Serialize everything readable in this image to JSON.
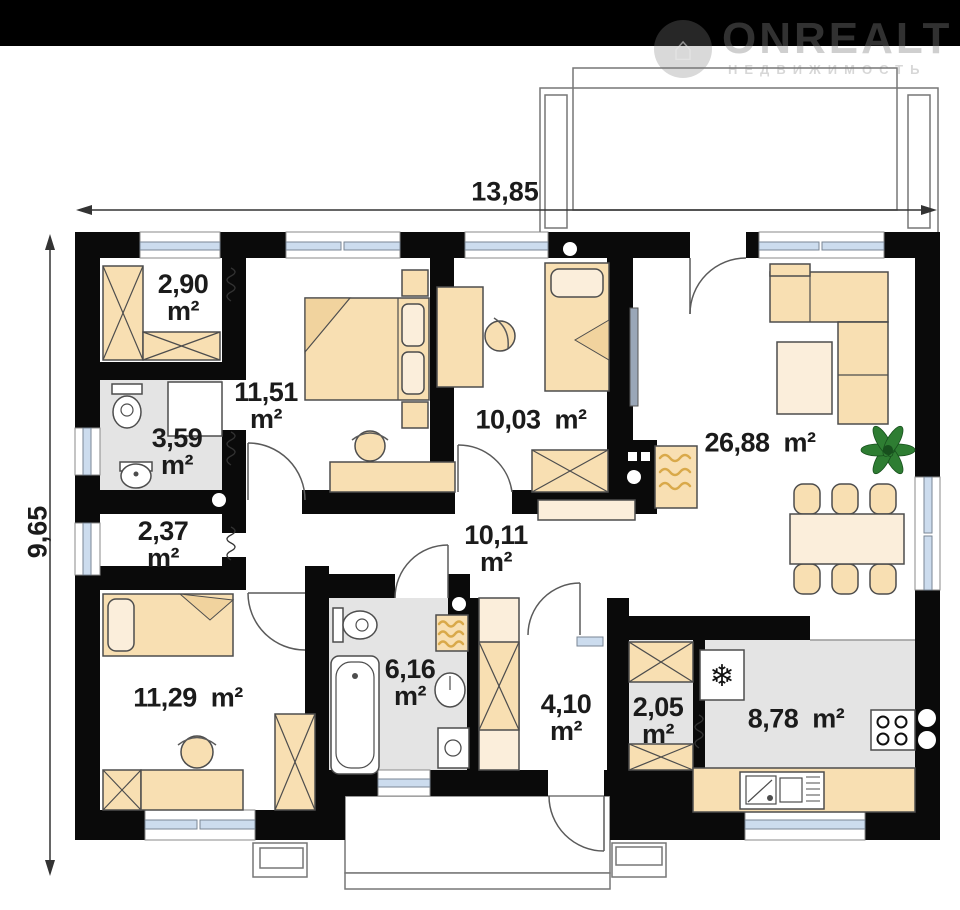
{
  "watermark": {
    "brand": "ONREALT",
    "subtitle": "НЕДВИЖИМОСТЬ",
    "icon": "house-icon",
    "house_glyph": "⌂"
  },
  "dimensions": {
    "width_label": "13,85",
    "height_label": "9,65"
  },
  "rooms": [
    {
      "name": "wardrobe",
      "area": "2,90",
      "unit": "m²"
    },
    {
      "name": "bathroom-top",
      "area": "3,59",
      "unit": "m²"
    },
    {
      "name": "bedroom-1",
      "area": "11,51",
      "unit": "m²"
    },
    {
      "name": "bedroom-2",
      "area": "10,03",
      "unit": "m²"
    },
    {
      "name": "living-room",
      "area": "26,88",
      "unit": "m²"
    },
    {
      "name": "closet",
      "area": "2,37",
      "unit": "m²"
    },
    {
      "name": "hallway",
      "area": "10,11",
      "unit": "m²"
    },
    {
      "name": "bedroom-3",
      "area": "11,29",
      "unit": "m²"
    },
    {
      "name": "bathroom-bottom",
      "area": "6,16",
      "unit": "m²"
    },
    {
      "name": "entry-hall",
      "area": "4,10",
      "unit": "m²"
    },
    {
      "name": "pantry",
      "area": "2,05",
      "unit": "m²"
    },
    {
      "name": "kitchen",
      "area": "8,78",
      "unit": "m²"
    }
  ],
  "icons": {
    "snowflake": "❄"
  },
  "colors": {
    "bar": "#000000",
    "wall": "#0a0a0a",
    "furn": "#f8dfb2",
    "furn_light": "#fbeedb",
    "wet": "#e4e4e4",
    "glass": "#ccdcee",
    "radiator": "#d9a94a",
    "plant": "#2e7d32"
  }
}
